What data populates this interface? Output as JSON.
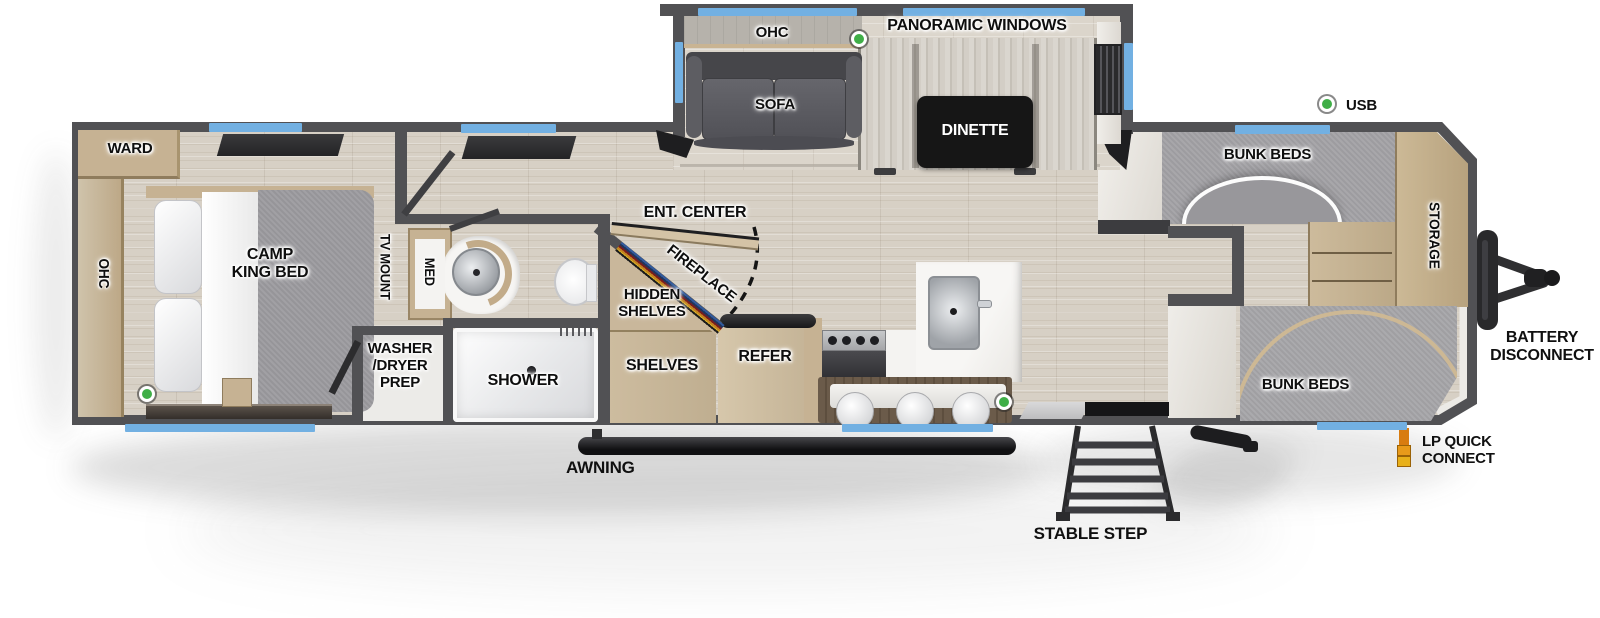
{
  "meta": {
    "type": "rv-travel-trailer-floorplan"
  },
  "colors": {
    "wall": "#515154",
    "floor": "#d7d0c5",
    "slide_floor": "#dbd5cb",
    "window_accent": "#72b0e2",
    "led_green": "#3fae47",
    "lp_orange": "#e08a12",
    "cabinet_tan": "#c6b293",
    "mattress_gray": "#a3a2a6",
    "table_black": "#161616",
    "sofa_gray": "#56565b",
    "fixture_white": "#f4f3f1"
  },
  "slideout": {
    "panoramic_windows": "PANORAMIC WINDOWS",
    "ohc": "OHC",
    "sofa": "SOFA",
    "dinette": "DINETTE"
  },
  "bedroom": {
    "ward": "WARD",
    "ohc": "OHC",
    "bed": "CAMP\nKING BED",
    "tv_mount": "TV MOUNT"
  },
  "bathroom": {
    "med": "MED",
    "shower": "SHOWER",
    "washer_dryer_prep": "WASHER\n/DRYER\nPREP"
  },
  "living": {
    "ent_center": "ENT. CENTER",
    "fireplace": "FIREPLACE",
    "hidden_shelves": "HIDDEN\nSHELVES",
    "shelves": "SHELVES",
    "refer": "REFER"
  },
  "bunkhouse": {
    "bunk_beds_top": "BUNK BEDS",
    "bunk_beds_bottom": "BUNK BEDS",
    "storage": "STORAGE"
  },
  "exterior": {
    "usb": "USB",
    "battery_disconnect": "BATTERY\nDISCONNECT",
    "lp_quick_connect": "LP QUICK\nCONNECT",
    "awning": "AWNING",
    "stable_step": "STABLE STEP"
  }
}
